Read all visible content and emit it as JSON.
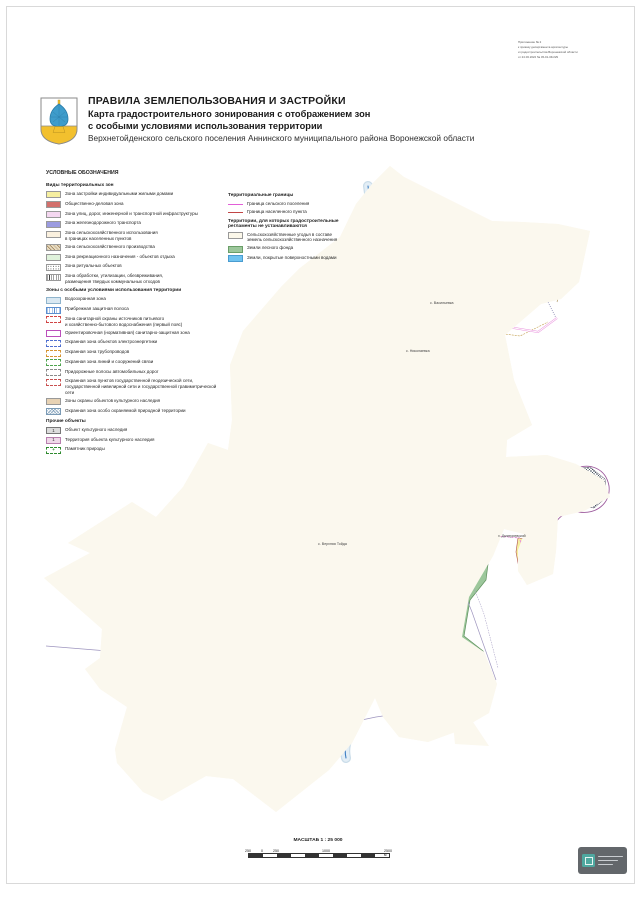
{
  "appendix": {
    "lines": [
      "Приложение № 2",
      "к приказу департамента архитектуры",
      "и градостроительства Воронежской области",
      "от 24.03.2022 № 45-01-04/229"
    ]
  },
  "header": {
    "title_main": "ПРАВИЛА ЗЕМЛЕПОЛЬЗОВАНИЯ И ЗАСТРОЙКИ",
    "subtitle_1": "Карта градостроительного зонирования с отображением зон",
    "subtitle_2": "с особыми условиями использования территории",
    "subtitle_3": "Верхнетойденского сельского поселения Аннинского муниципального района Воронежской области"
  },
  "legend": {
    "title": "УСЛОВНЫЕ ОБОЗНАЧЕНИЯ",
    "columns": [
      {
        "sections": [
          {
            "title": "Виды территориальных зон",
            "items": [
              {
                "swatch": "zone-yellow",
                "label": "Зона застройки индивидуальными жилыми домами"
              },
              {
                "swatch": "zone-red",
                "label": "Общественно-деловая зона"
              },
              {
                "swatch": "zone-pink",
                "label": "Зона улиц, дорог, инженерной и транспортной инфраструктуры"
              },
              {
                "swatch": "zone-violet",
                "label": "Зона железнодорожного транспорта"
              },
              {
                "swatch": "zone-cream",
                "label": "Зона сельскохозяйственного использования\nв границах населенных пунктов"
              },
              {
                "swatch": "zone-hatch-tan",
                "label": "Зона сельскохозяйственного производства"
              },
              {
                "swatch": "zone-lightgreen",
                "label": "Зона рекреационного назначения - объектов отдыха"
              },
              {
                "swatch": "zone-dots",
                "label": "Зона ритуальных объектов"
              },
              {
                "swatch": "zone-vlines",
                "label": "Зона обработки, утилизации, обезвреживания,\nразмещения твердых коммунальных отходов"
              }
            ]
          },
          {
            "title": "Зоны  с особыми условиями использования территории",
            "items": [
              {
                "swatch": "sz-water",
                "label": "Водоохранная зона"
              },
              {
                "swatch": "sz-coast",
                "label": "Прибрежная защитная полоса"
              },
              {
                "swatch": "sz-zso",
                "label": "Зона санитарной охраны источников питьевого\nи хозяйственно-бытового водоснабжения (первый пояс)"
              },
              {
                "swatch": "sz-szz",
                "label": "Ориентировочная (нормативная) санитарно-защитная зона"
              },
              {
                "swatch": "sz-electro",
                "label": "Охранная зона объектов электроэнергетики"
              },
              {
                "swatch": "sz-pipe",
                "label": "Охранная зона трубопроводов"
              },
              {
                "swatch": "sz-comm",
                "label": "Охранная зона линий и сооружений связи"
              },
              {
                "swatch": "sz-roadside",
                "label": "Придорожные полосы автомобильных дорог"
              },
              {
                "swatch": "sz-geo",
                "label": "Охранная зона пунктов государственной геодезической сети,\nгосударственной нивелирной сети и государственной гравиметрической сети"
              },
              {
                "swatch": "sz-heritage",
                "label": "Зоны охраны объектов культурного наследия"
              },
              {
                "swatch": "sz-oopt",
                "label": "Охранная зона особо охраняемой природной территории"
              }
            ]
          },
          {
            "title": "Прочие объекты",
            "items": [
              {
                "swatch": "okn-obj",
                "symbol": "1",
                "label": "Объект культурного наследия"
              },
              {
                "swatch": "okn-ter",
                "symbol": "1",
                "label": "Территория объекта культурного наследия"
              },
              {
                "swatch": "nat-mon",
                "symbol": "+",
                "label": "Памятник природы"
              }
            ]
          }
        ]
      },
      {
        "sections": [
          {
            "title": "Территориальные границы",
            "items": [
              {
                "swatch": "line-magenta",
                "label": "Граница сельского поселения"
              },
              {
                "swatch": "line-red",
                "label": "Граница населенного пункта"
              }
            ]
          },
          {
            "title": "Территории, для которых градостроительные\nрегламенты не устанавливаются",
            "items": [
              {
                "swatch": "ter-cream",
                "label": "Сельскохозяйственные угодья в составе\nземель сельскохозяйственного назначения"
              },
              {
                "swatch": "ter-green",
                "label": "Земли лесного фонда"
              },
              {
                "swatch": "ter-blue",
                "label": "Земли, покрытые поверхностными водами"
              }
            ]
          }
        ]
      }
    ]
  },
  "map": {
    "labels": [
      {
        "text": "с. Васильевка",
        "x": 430,
        "y": 304
      },
      {
        "text": "с. Николаевка",
        "x": 406,
        "y": 352
      },
      {
        "text": "с. Верхняя Тойда",
        "x": 318,
        "y": 545
      },
      {
        "text": "х. Дмитриевский",
        "x": 498,
        "y": 537
      }
    ],
    "colors": {
      "settlement_boundary": "#EA5FD6",
      "locality_boundary": "#C24545",
      "residential": "#F6EFA0",
      "public_business": "#D2706C",
      "railway": "#9898E2",
      "agri_in_settlement": "#FAF0DE",
      "forest": "#9CC79B",
      "water": "#59B7EE",
      "river_line": "#3E7EC2",
      "sanitary_zone": "#A855A8",
      "territory_fill": "#FBF8EE"
    }
  },
  "scalebar": {
    "title": "МАСШТАБ 1 : 25 000",
    "ticks": [
      "250",
      "0",
      "250",
      "1000",
      "2500 м"
    ]
  }
}
